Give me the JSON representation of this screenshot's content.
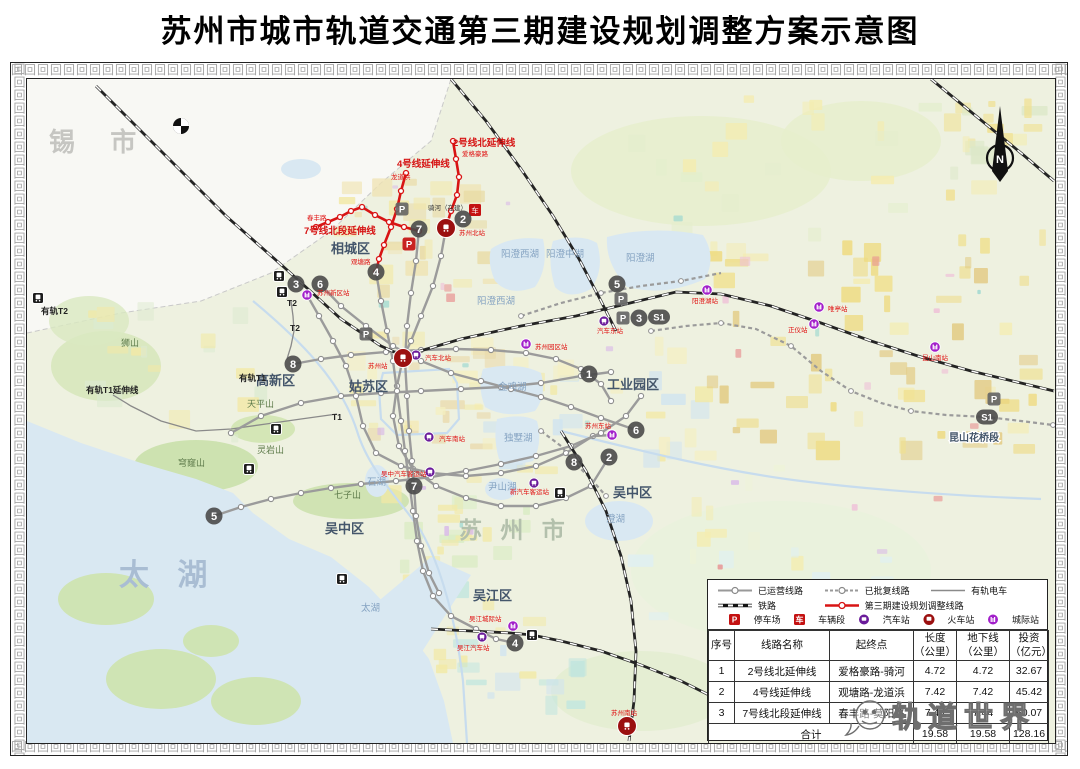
{
  "title": "苏州市城市轨道交通第三期建设规划调整方案示意图",
  "map": {
    "compass_label": "N",
    "corner_city_label": "锡  市",
    "kunshan_section_label": "昆山花桥段",
    "watermark_text": "轨道世界",
    "big_labels": [
      {
        "text": "太  湖",
        "x": 118,
        "y": 584,
        "size": 30,
        "color": "#a9bdd3",
        "ls": 10
      },
      {
        "text": "苏 州 市",
        "x": 458,
        "y": 537,
        "size": 23,
        "color": "#b3c0ac",
        "ls": 6
      }
    ],
    "district_labels": [
      {
        "text": "相城区",
        "x": 330,
        "y": 252
      },
      {
        "text": "姑苏区",
        "x": 348,
        "y": 390
      },
      {
        "text": "高新区",
        "x": 255,
        "y": 384
      },
      {
        "text": "工业园区",
        "x": 606,
        "y": 388
      },
      {
        "text": "吴中区",
        "x": 324,
        "y": 532
      },
      {
        "text": "吴中区",
        "x": 612,
        "y": 496
      },
      {
        "text": "吴江区",
        "x": 472,
        "y": 599
      }
    ],
    "lake_labels": [
      {
        "text": "阳澄西湖",
        "x": 500,
        "y": 256
      },
      {
        "text": "阳澄中湖",
        "x": 545,
        "y": 256
      },
      {
        "text": "阳澄湖",
        "x": 625,
        "y": 260
      },
      {
        "text": "阳澄西湖",
        "x": 476,
        "y": 303
      },
      {
        "text": "金鸡湖",
        "x": 497,
        "y": 389
      },
      {
        "text": "独墅湖",
        "x": 503,
        "y": 440
      },
      {
        "text": "尹山湖",
        "x": 487,
        "y": 489
      },
      {
        "text": "澄湖",
        "x": 605,
        "y": 521
      },
      {
        "text": "石湖",
        "x": 366,
        "y": 484
      },
      {
        "text": "太湖",
        "x": 360,
        "y": 610
      }
    ],
    "mountain_labels": [
      {
        "text": "七子山",
        "x": 333,
        "y": 497
      },
      {
        "text": "穹窿山",
        "x": 177,
        "y": 465
      },
      {
        "text": "天平山",
        "x": 246,
        "y": 406
      },
      {
        "text": "灵岩山",
        "x": 256,
        "y": 452
      },
      {
        "text": "狮山",
        "x": 120,
        "y": 345
      }
    ],
    "tram_labels": [
      {
        "text": "有轨T1延伸线",
        "x": 85,
        "y": 392
      },
      {
        "text": "有轨T1",
        "x": 238,
        "y": 380
      },
      {
        "text": "有轨T2",
        "x": 40,
        "y": 313
      },
      {
        "text": "T2",
        "x": 286,
        "y": 305
      },
      {
        "text": "T2",
        "x": 289,
        "y": 330
      },
      {
        "text": "T1",
        "x": 331,
        "y": 419
      }
    ],
    "red_line_labels": [
      {
        "text": "2号线北延伸线",
        "x": 452,
        "y": 145
      },
      {
        "text": "4号线延伸线",
        "x": 396,
        "y": 166
      },
      {
        "text": "7号线北段延伸线",
        "x": 303,
        "y": 233
      }
    ],
    "red_station_labels": [
      {
        "text": "爱格豪路",
        "x": 461,
        "y": 155
      },
      {
        "text": "龙道浜",
        "x": 390,
        "y": 178
      },
      {
        "text": "春丰路",
        "x": 306,
        "y": 219
      },
      {
        "text": "观塘路",
        "x": 350,
        "y": 263
      },
      {
        "text": "苏州北站",
        "x": 458,
        "y": 234
      },
      {
        "text": "苏州站",
        "x": 367,
        "y": 367
      },
      {
        "text": "汽车北站",
        "x": 424,
        "y": 359
      },
      {
        "text": "苏州园区站",
        "x": 534,
        "y": 348
      },
      {
        "text": "苏州东站",
        "x": 584,
        "y": 427
      },
      {
        "text": "苏州新区站",
        "x": 316,
        "y": 294
      },
      {
        "text": "汽车东站",
        "x": 596,
        "y": 332
      },
      {
        "text": "汽车南站",
        "x": 438,
        "y": 440
      },
      {
        "text": "吴中汽车客运站",
        "x": 380,
        "y": 475
      },
      {
        "text": "新汽车客运站",
        "x": 509,
        "y": 493
      },
      {
        "text": "阳澄湖站",
        "x": 691,
        "y": 302
      },
      {
        "text": "唯亭站",
        "x": 827,
        "y": 310
      },
      {
        "text": "正仪站",
        "x": 787,
        "y": 331
      },
      {
        "text": "昆山南站",
        "x": 921,
        "y": 359
      },
      {
        "text": "吴江城际站",
        "x": 468,
        "y": 620
      },
      {
        "text": "吴江汽车站",
        "x": 456,
        "y": 649
      },
      {
        "text": "苏州南站",
        "x": 610,
        "y": 714
      }
    ],
    "dark_station_labels": [
      {
        "text": "骑河（在建）",
        "x": 427,
        "y": 209
      }
    ],
    "badges": [
      {
        "t": "1",
        "x": 588,
        "y": 373
      },
      {
        "t": "2",
        "x": 462,
        "y": 218
      },
      {
        "t": "2",
        "x": 608,
        "y": 456
      },
      {
        "t": "3",
        "x": 295,
        "y": 283
      },
      {
        "t": "3",
        "x": 638,
        "y": 317
      },
      {
        "t": "4",
        "x": 375,
        "y": 271
      },
      {
        "t": "4",
        "x": 514,
        "y": 642
      },
      {
        "t": "5",
        "x": 616,
        "y": 283
      },
      {
        "t": "5",
        "x": 213,
        "y": 515
      },
      {
        "t": "6",
        "x": 319,
        "y": 283
      },
      {
        "t": "6",
        "x": 635,
        "y": 429
      },
      {
        "t": "7",
        "x": 418,
        "y": 228
      },
      {
        "t": "7",
        "x": 413,
        "y": 485
      },
      {
        "t": "8",
        "x": 292,
        "y": 363
      },
      {
        "t": "8",
        "x": 573,
        "y": 461
      }
    ],
    "pill_badges": [
      {
        "t": "S1",
        "x": 658,
        "y": 316
      },
      {
        "t": "S1",
        "x": 986,
        "y": 416
      }
    ],
    "p_badges": [
      {
        "x": 365,
        "y": 333
      },
      {
        "x": 620,
        "y": 298
      },
      {
        "x": 622,
        "y": 317
      },
      {
        "x": 993,
        "y": 398
      },
      {
        "x": 401,
        "y": 208
      }
    ],
    "red_p_icons": [
      {
        "x": 408,
        "y": 243
      }
    ],
    "depot_icons": [
      {
        "x": 474,
        "y": 209
      }
    ],
    "bus_stations": [
      {
        "x": 415,
        "y": 354
      },
      {
        "x": 603,
        "y": 320
      },
      {
        "x": 428,
        "y": 436
      },
      {
        "x": 429,
        "y": 471
      },
      {
        "x": 533,
        "y": 482
      },
      {
        "x": 481,
        "y": 636
      }
    ],
    "intercity_stations": [
      {
        "x": 306,
        "y": 294
      },
      {
        "x": 525,
        "y": 343
      },
      {
        "x": 611,
        "y": 434
      },
      {
        "x": 706,
        "y": 289
      },
      {
        "x": 818,
        "y": 306
      },
      {
        "x": 813,
        "y": 323
      },
      {
        "x": 934,
        "y": 346
      },
      {
        "x": 512,
        "y": 625
      }
    ],
    "rail_stations": [
      {
        "x": 402,
        "y": 357
      },
      {
        "x": 445,
        "y": 227
      },
      {
        "x": 626,
        "y": 725
      }
    ],
    "train_icons": [
      {
        "x": 278,
        "y": 275
      },
      {
        "x": 281,
        "y": 291
      },
      {
        "x": 37,
        "y": 297
      },
      {
        "x": 275,
        "y": 428
      },
      {
        "x": 248,
        "y": 468
      },
      {
        "x": 559,
        "y": 492
      },
      {
        "x": 341,
        "y": 578
      },
      {
        "x": 531,
        "y": 634
      }
    ]
  },
  "legend": {
    "rows": [
      [
        {
          "swatch": "operating",
          "label": "已运营线路"
        },
        {
          "swatch": "approved",
          "label": "已批复线路"
        },
        {
          "swatch": "tram",
          "label": "有轨电车"
        }
      ],
      [
        {
          "swatch": "railway",
          "label": "铁路"
        },
        {
          "swatch": "phase3",
          "label": "第三期建设规划调整线路"
        }
      ],
      [
        {
          "swatch": "parking",
          "label": "停车场"
        },
        {
          "swatch": "depot",
          "label": "车辆段"
        },
        {
          "swatch": "bus",
          "label": "汽车站"
        },
        {
          "swatch": "train",
          "label": "火车站"
        },
        {
          "swatch": "intercity",
          "label": "城际站"
        }
      ]
    ]
  },
  "table": {
    "headers": [
      [
        "序号"
      ],
      [
        "线路名称"
      ],
      [
        "起终点"
      ],
      [
        "长度",
        "（公里）"
      ],
      [
        "地下线",
        "（公里）"
      ],
      [
        "投资",
        "（亿元）"
      ]
    ],
    "rows": [
      [
        "1",
        "2号线北延伸线",
        "爱格豪路-骑河",
        "4.72",
        "4.72",
        "32.67"
      ],
      [
        "2",
        "4号线延伸线",
        "观塘路-龙道浜",
        "7.42",
        "7.42",
        "45.42"
      ],
      [
        "3",
        "7号线北段延伸线",
        "春丰路-莫阳路",
        "7.44",
        "7.44",
        "50.07"
      ]
    ],
    "total": {
      "label": "合计",
      "length": "19.58",
      "underground": "19.58",
      "investment": "128.16"
    }
  },
  "colors": {
    "phase3_red": "#d81414",
    "metro_gray": "#9b9b9b",
    "badge_gray": "#4a4a4a",
    "bus_purple": "#6a1b9a",
    "intercity_magenta": "#a21fca",
    "rail_darkred": "#9b1010",
    "water": "#d9e8f2",
    "label_red": "#e01010"
  }
}
